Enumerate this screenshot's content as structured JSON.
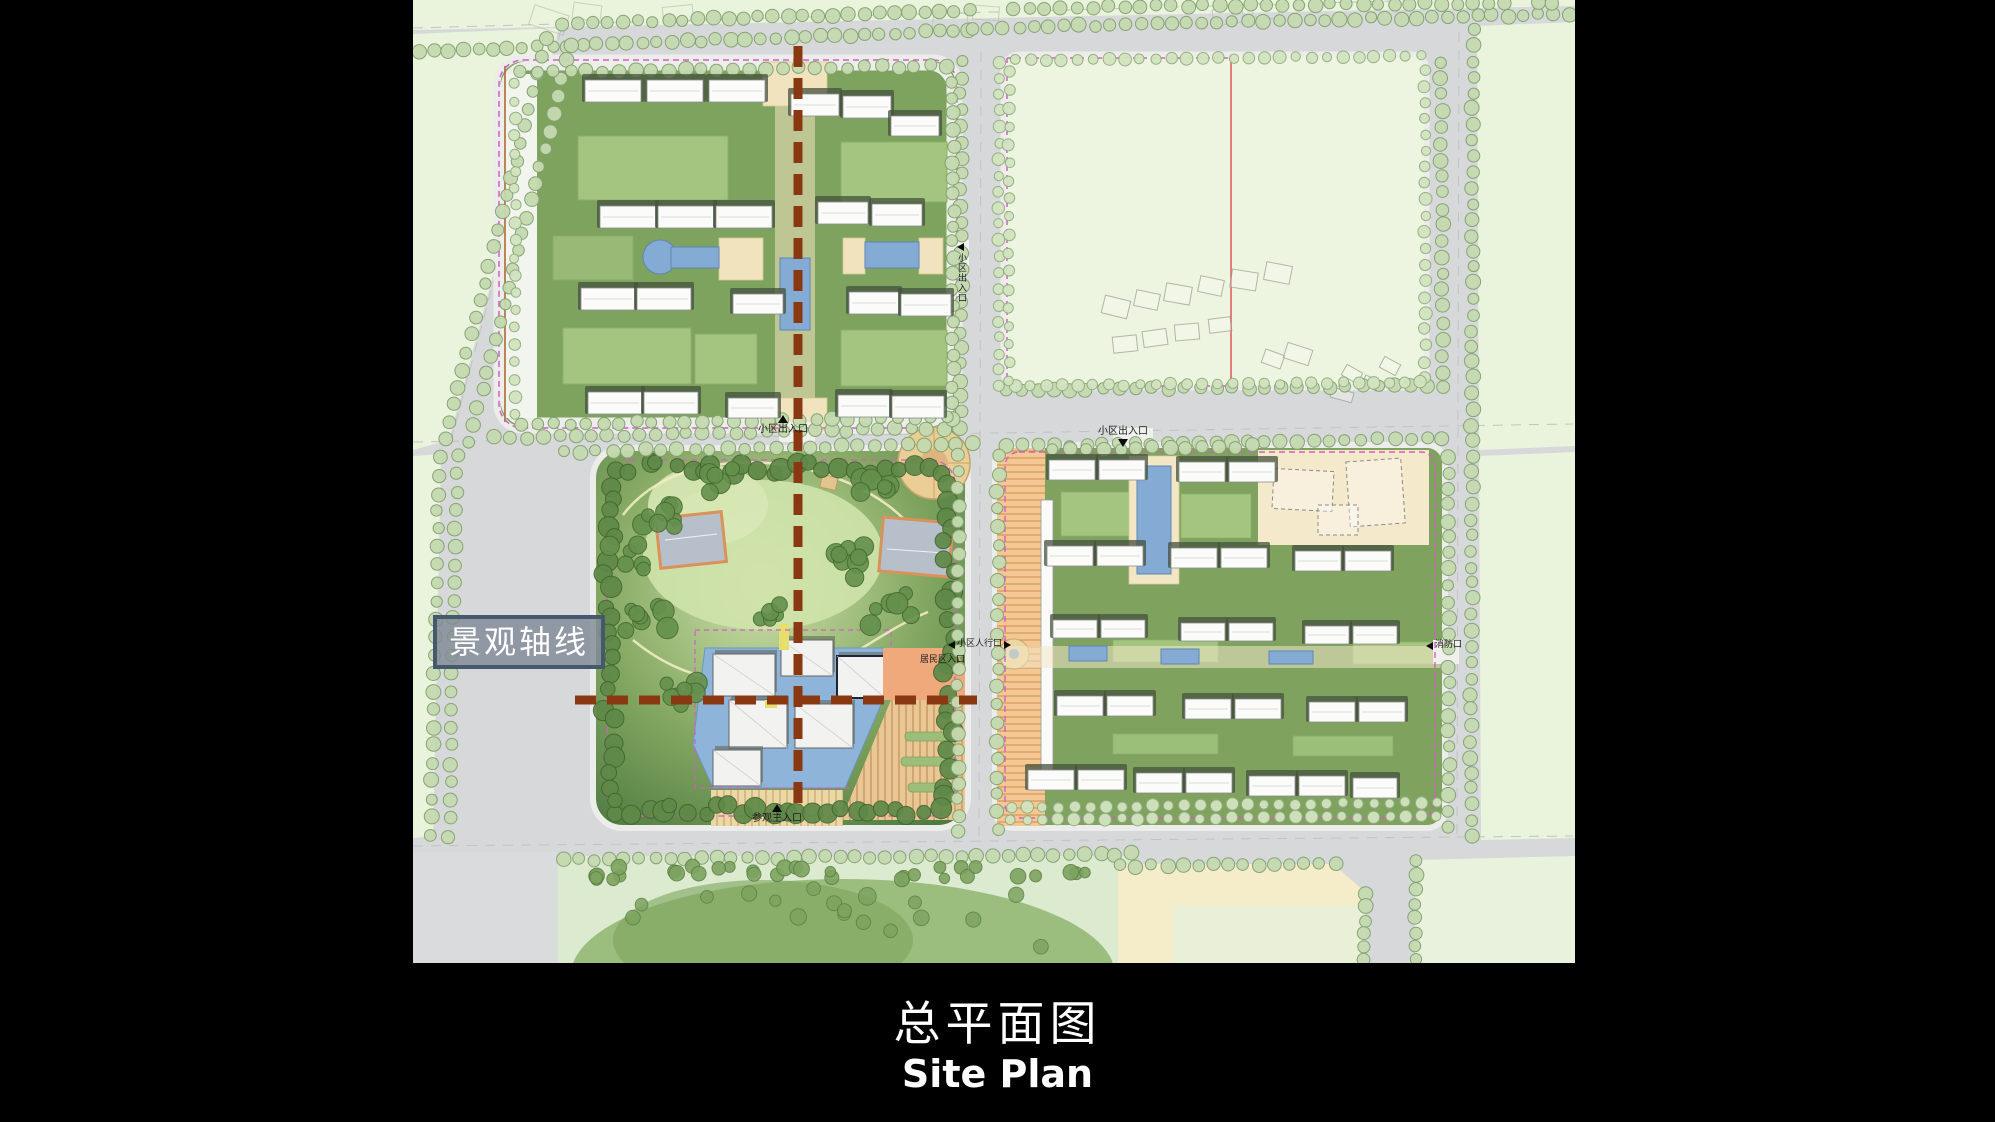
{
  "slide": {
    "title_zh": "总平面图",
    "title_en": "Site Plan"
  },
  "plan": {
    "axis_label": "景观轴线",
    "entrance_labels": {
      "community_gate_north": "小区出入口",
      "community_gate_east": "小区出入口",
      "community_gate_south": "小区出入口",
      "pedestrian_gate": "小区人行口",
      "resident_gate": "居民区入口",
      "main_visitor_gate": "参观主入口",
      "fire_gate": "消防口"
    },
    "colors": {
      "background": "#000000",
      "axis_line": "#8a3812",
      "site_boundary": "#d45cc8",
      "water": "#8fb4d9",
      "road": "#d7d8da",
      "parcel_green": "#7ea35f"
    }
  }
}
